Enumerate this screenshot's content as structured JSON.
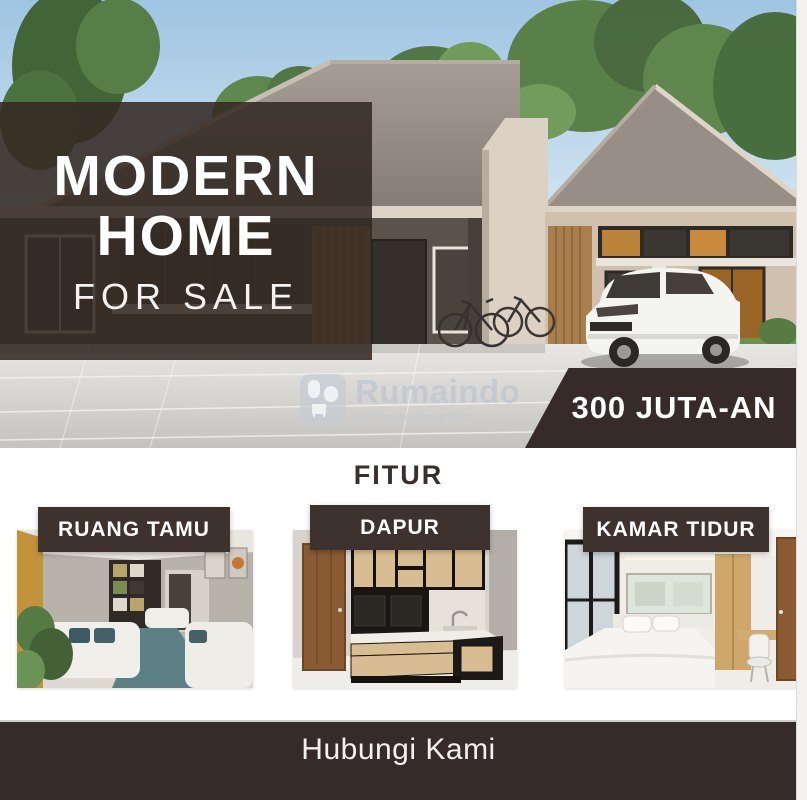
{
  "flyer": {
    "hero": {
      "title_line1": "MODERN",
      "title_line2": "HOME",
      "subtitle": "FOR SALE",
      "price_badge": "300 JUTA-AN",
      "watermark": {
        "brand": "Rumaindo",
        "tagline": "Cari Properti Tanpa Ribet"
      }
    },
    "features": {
      "heading": "FITUR",
      "cards": [
        {
          "id": "living-room",
          "label": "RUANG TAMU"
        },
        {
          "id": "kitchen",
          "label": "DAPUR"
        },
        {
          "id": "bedroom",
          "label": "KAMAR TIDUR"
        }
      ]
    },
    "footer": {
      "cta": "Hubungi Kami"
    },
    "colors": {
      "brand_dark": "#362b28",
      "label_dark": "#3d322e",
      "text_light": "#ffffff"
    }
  }
}
